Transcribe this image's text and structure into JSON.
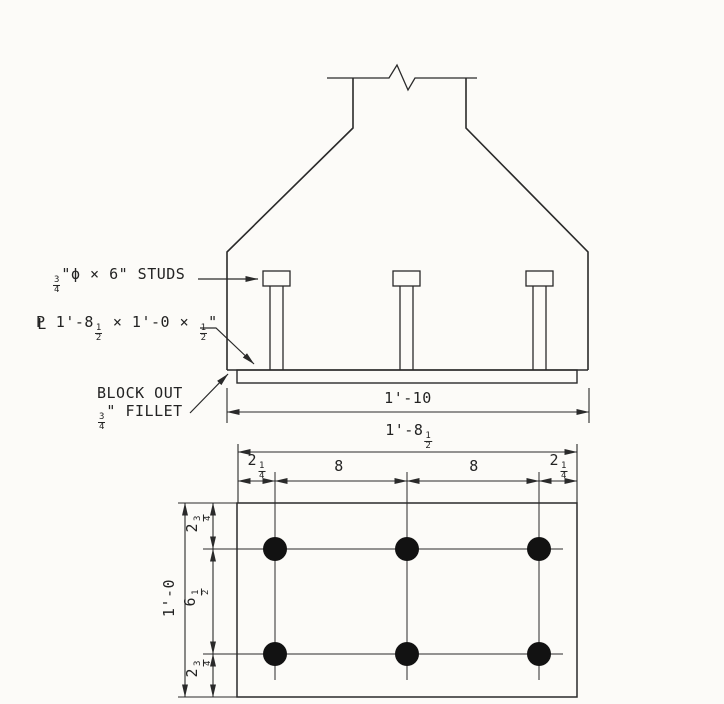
{
  "colors": {
    "paper": "#fcfbf8",
    "ink": "#2a2a2a",
    "stud_fill": "#121212"
  },
  "elevation": {
    "stud_callout": {
      "frac_num": "3",
      "frac_den": "4",
      "text": "\"ϕ × 6\" STUDS"
    },
    "plate_callout": {
      "sym_p": "P",
      "sym_l": "L",
      "pre": " 1'-8",
      "f1_num": "1",
      "f1_den": "2",
      "mid": " × 1'-0 × ",
      "f2_num": "1",
      "f2_den": "2",
      "post": "\""
    },
    "blockout_callout": {
      "line1": "BLOCK OUT",
      "frac_num": "3",
      "frac_den": "4",
      "line2": "\" FILLET"
    },
    "overall_width_dim": "1'-10"
  },
  "plan": {
    "overall_width_dim": {
      "pre": "1'-8",
      "frac_num": "1",
      "frac_den": "2"
    },
    "spacing_dims": {
      "left_edge": {
        "pre": "2",
        "frac_num": "1",
        "frac_den": "4"
      },
      "left_span": "8",
      "right_span": "8",
      "right_edge": {
        "pre": "2",
        "frac_num": "1",
        "frac_den": "4"
      }
    },
    "vertical_dims": {
      "top_edge": {
        "pre": "2",
        "frac_num": "3",
        "frac_den": "4"
      },
      "middle_span": {
        "pre": "6",
        "frac_num": "1",
        "frac_den": "2"
      },
      "bottom_edge": {
        "pre": "2",
        "frac_num": "3",
        "frac_den": "4"
      },
      "overall_height": "1'-0"
    },
    "stud_grid": {
      "rows": 2,
      "cols": 3,
      "count": 6
    }
  }
}
